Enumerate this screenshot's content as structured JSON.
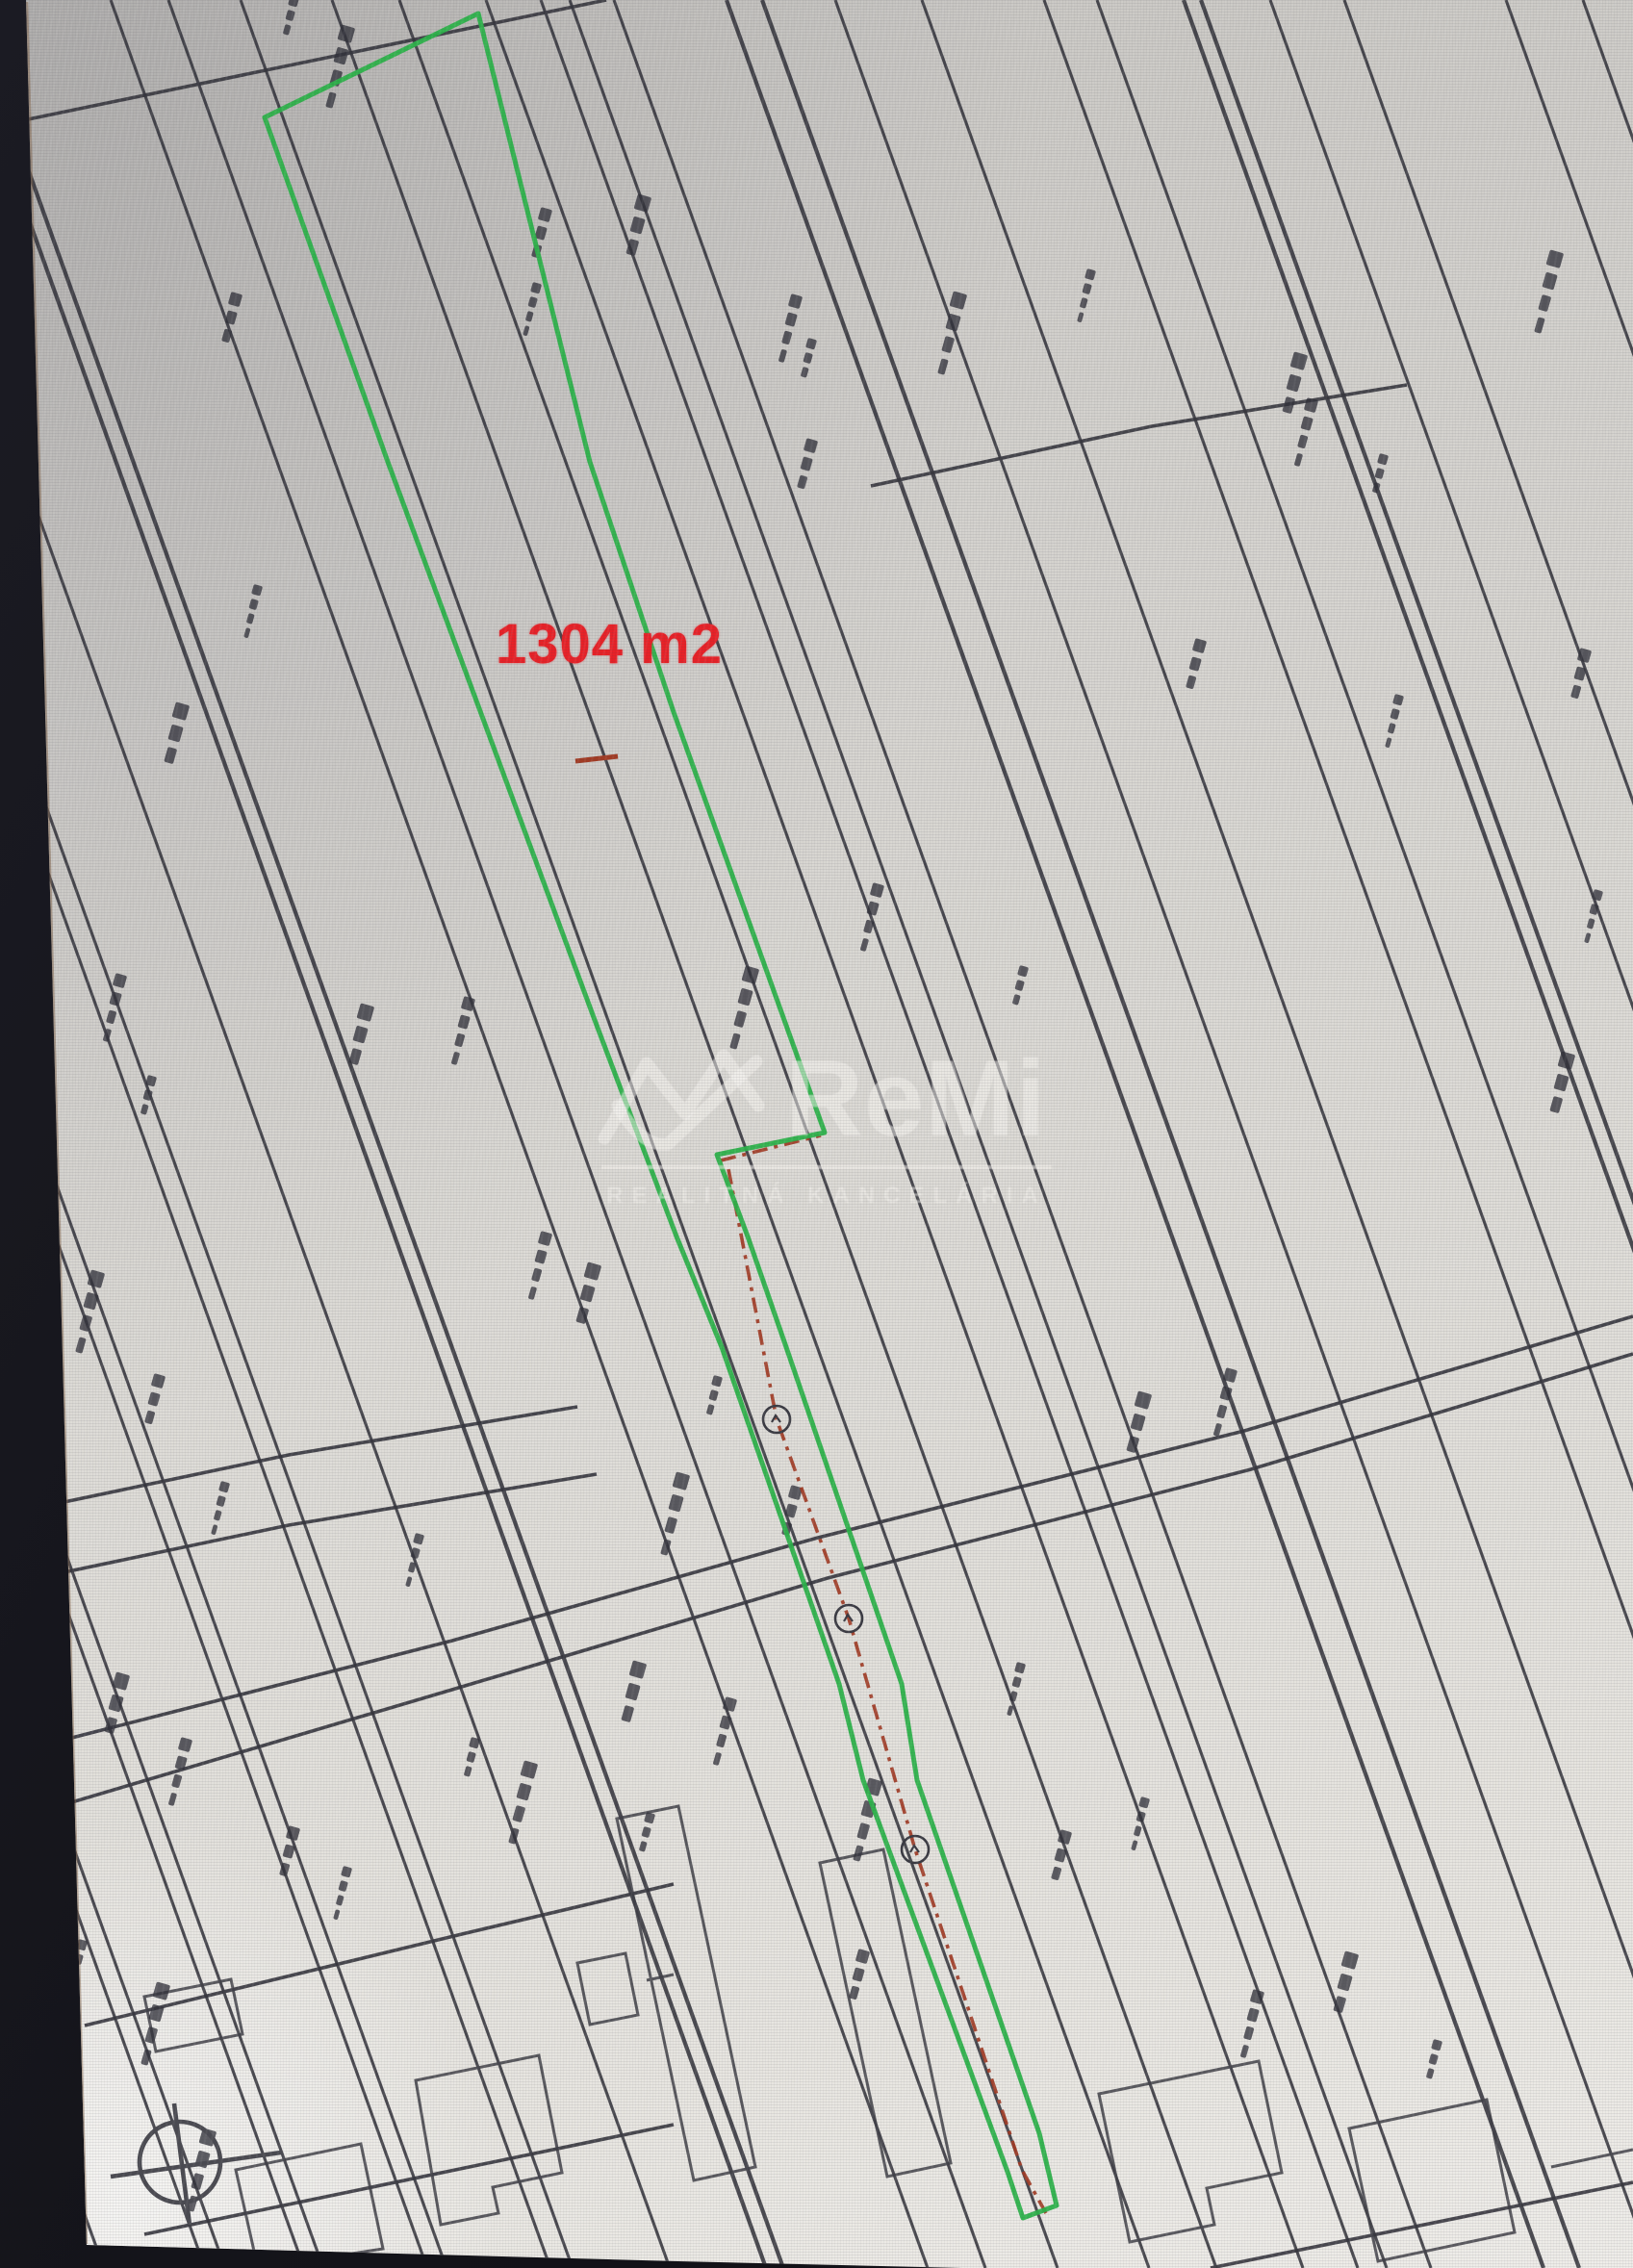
{
  "map": {
    "area_label": "1304 m2",
    "area_label_color": "#e82127",
    "parcel_outline_color": "#2cb34a",
    "parcel_boundary_color": "#a23b24",
    "paper_color": "#dcdad5",
    "line_color": "#35353d",
    "utility_marker_count": 3
  },
  "watermark": {
    "brand": "ReMi",
    "subtitle": "REALITNÁ KANCELÁRIA",
    "color": "#f5f3ef"
  }
}
